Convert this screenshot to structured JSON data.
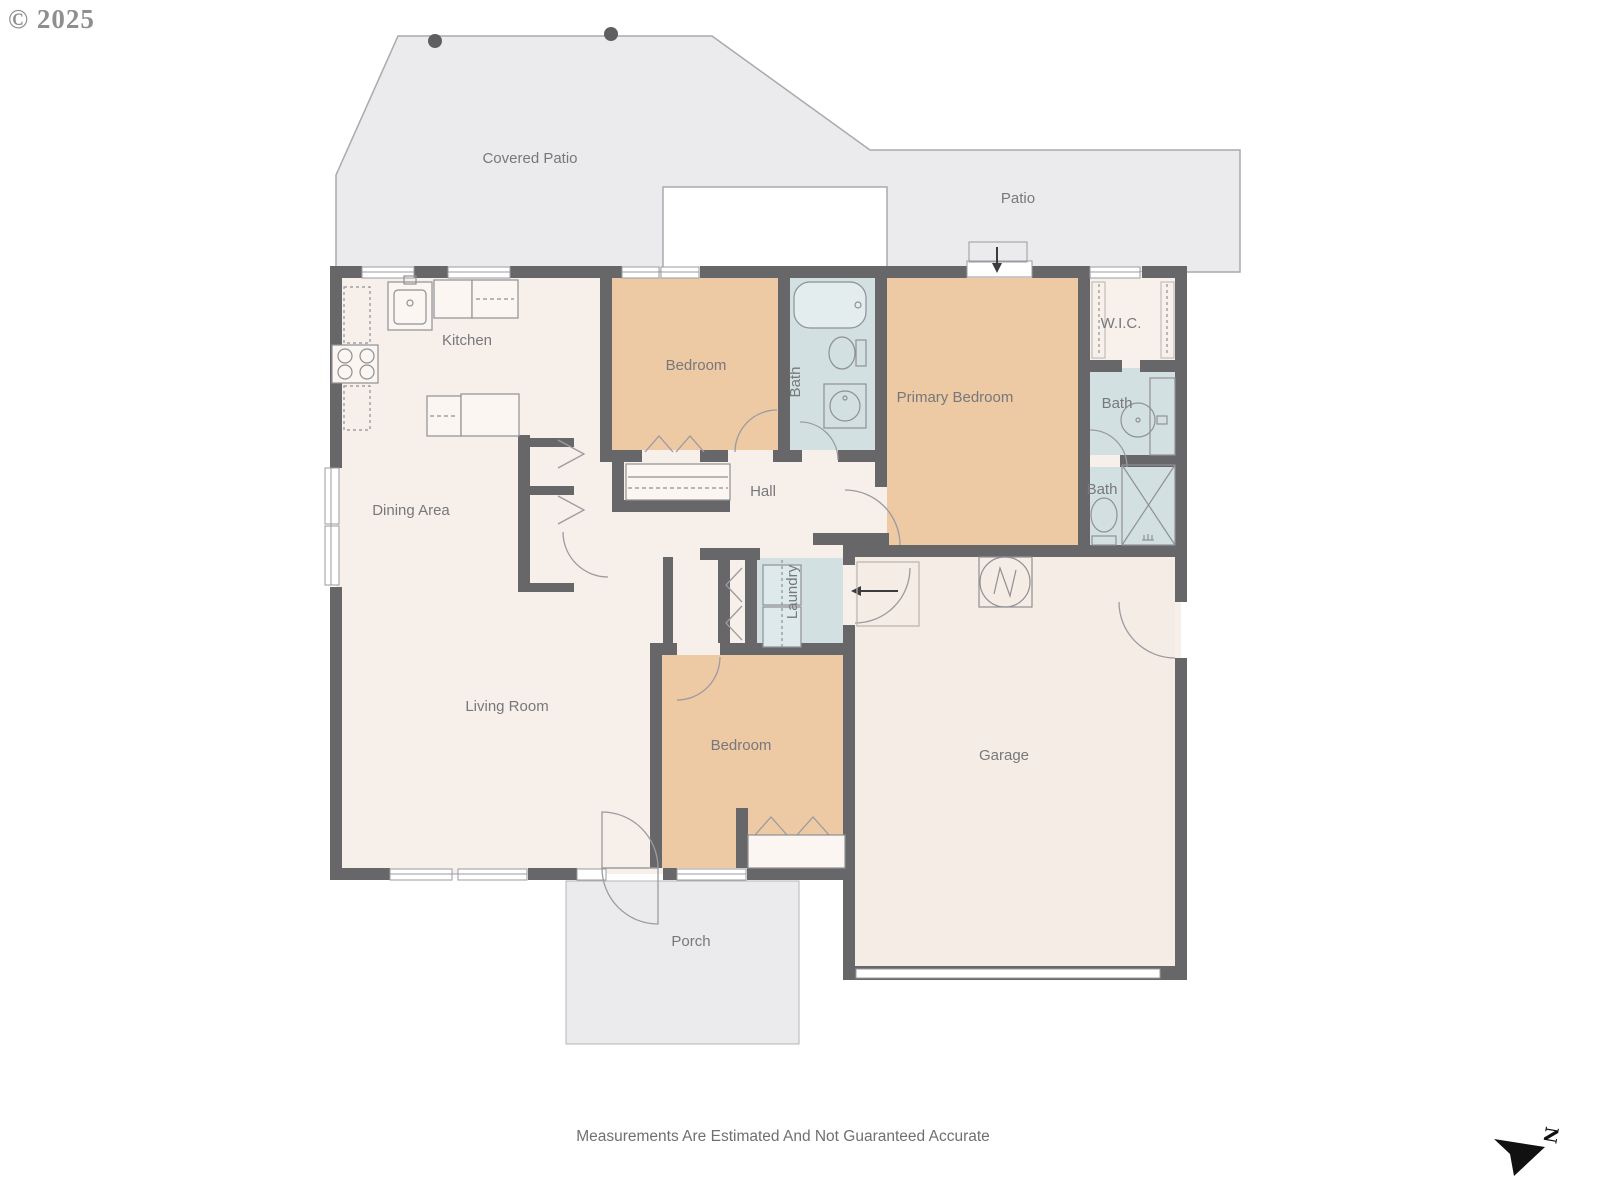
{
  "meta": {
    "copyright": "© 2025",
    "disclaimer": "Measurements Are Estimated And Not Guaranteed Accurate",
    "compass_label": "N"
  },
  "colors": {
    "wall": "#67676a",
    "floor_cream": "#f7efe9",
    "garage_floor": "#f5ece5",
    "bedroom_tan": "#edc9a4",
    "bath_blue": "#d2e0e2",
    "outdoor_gray": "#ebebed",
    "outline_gray": "#a9a9af",
    "fixture_stroke": "#8f9094",
    "label_text": "#77787c"
  },
  "rooms": {
    "covered_patio": {
      "label": "Covered Patio"
    },
    "patio": {
      "label": "Patio"
    },
    "kitchen": {
      "label": "Kitchen"
    },
    "dining": {
      "label": "Dining Area"
    },
    "living": {
      "label": "Living Room"
    },
    "bedroom_top": {
      "label": "Bedroom"
    },
    "bath_hall": {
      "label": "Bath"
    },
    "primary_bedroom": {
      "label": "Primary Bedroom"
    },
    "wic": {
      "label": "W.I.C."
    },
    "bath_primary": {
      "label": "Bath"
    },
    "bath_lower": {
      "label": "Bath"
    },
    "hall": {
      "label": "Hall"
    },
    "laundry": {
      "label": "Laundry"
    },
    "bedroom_bottom": {
      "label": "Bedroom"
    },
    "garage": {
      "label": "Garage"
    },
    "porch": {
      "label": "Porch"
    }
  }
}
